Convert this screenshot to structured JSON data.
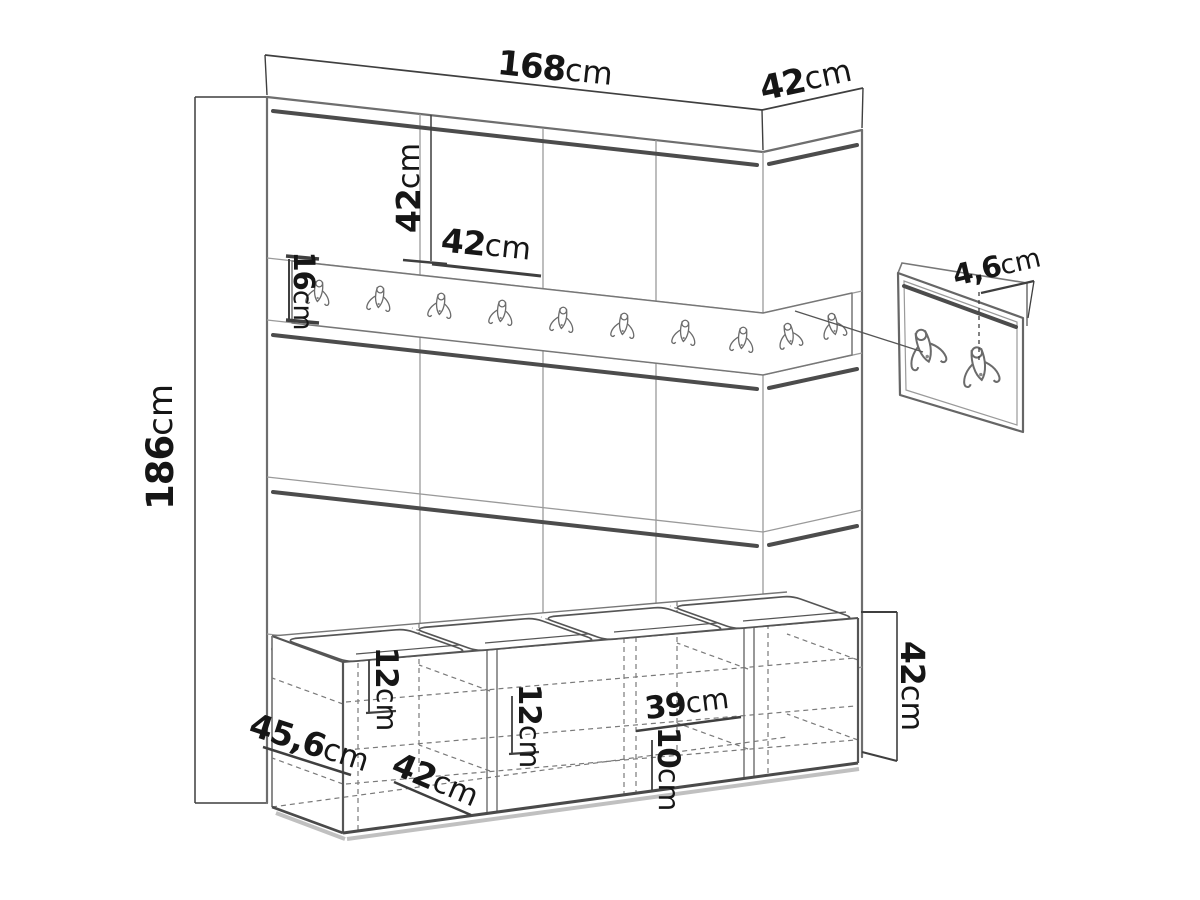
{
  "diagram": {
    "title": "hallway-furniture-set-dimension-drawing",
    "background": "#ffffff",
    "ink_color": "#161616",
    "line_color": "#5a5a5a"
  },
  "icons": {
    "coat_hook": "double-coat-hook"
  },
  "labels": {
    "total_width": {
      "num": "168",
      "unit": "cm"
    },
    "side_depth": {
      "num": "42",
      "unit": "cm"
    },
    "panel_height": {
      "num": "42",
      "unit": "cm"
    },
    "panel_width": {
      "num": "42",
      "unit": "cm"
    },
    "rail_height": {
      "num": "16",
      "unit": "cm"
    },
    "total_height": {
      "num": "186",
      "unit": "cm"
    },
    "hook_projection": {
      "num": "4,6",
      "unit": "cm"
    },
    "bench_height": {
      "num": "42",
      "unit": "cm"
    },
    "shelf_top": {
      "num": "12",
      "unit": "cm"
    },
    "shelf_mid": {
      "num": "12",
      "unit": "cm"
    },
    "inner_width": {
      "num": "39",
      "unit": "cm"
    },
    "shelf_bottom": {
      "num": "10",
      "unit": "cm"
    },
    "bench_depth": {
      "num": "45,6",
      "unit": "cm"
    },
    "bench_section_width": {
      "num": "42",
      "unit": "cm"
    }
  }
}
